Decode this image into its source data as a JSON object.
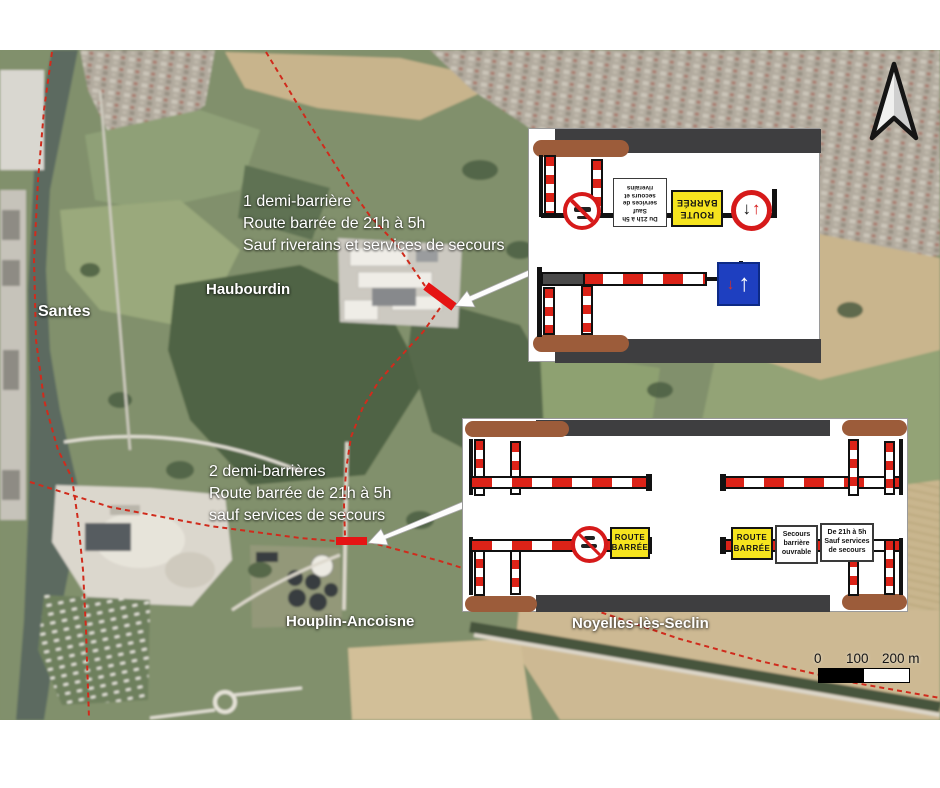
{
  "map": {
    "city_labels": [
      {
        "label": "Santes"
      },
      {
        "label": "Haubourdin"
      },
      {
        "label": "Houplin-Ancoisne"
      },
      {
        "label": "Noyelles-lès-Seclin"
      }
    ],
    "annotation_1": {
      "line1": "1 demi-barrière",
      "line2": "Route barrée de 21h à 5h",
      "line3": "Sauf riverains et services de secours"
    },
    "annotation_2": {
      "line1": "2 demi-barrières",
      "line2": "Route barrée de 21h à 5h",
      "line3": "sauf services de secours"
    }
  },
  "inset_top": {
    "time_sign": {
      "line1": "Du 21h à 5h",
      "line2": "Sauf",
      "line3": "services de",
      "line4": "secours et",
      "line5": "riverains"
    },
    "route_barree_sign": {
      "line1": "ROUTE",
      "line2": "BARRÉE"
    }
  },
  "inset_bottom": {
    "route_barree_left": {
      "line1": "ROUTE",
      "line2": "BARRÉE"
    },
    "route_barree_right": {
      "line1": "ROUTE",
      "line2": "BARRÉE"
    },
    "secours_sign": {
      "line1": "Secours",
      "line2": "barrière",
      "line3": "ouvrable"
    },
    "time_sign": {
      "line1": "De 21h à 5h",
      "line2": "Sauf services",
      "line3": "de secours"
    }
  },
  "scale_bar": {
    "tick0": "0",
    "tick100": "100",
    "tick200": "200 m"
  },
  "icons": {
    "up_arrow": "↑",
    "down_arrow": "↓"
  },
  "colors": {
    "boundary_red": "#d02b1c",
    "barrier_mark_red": "#e51414",
    "sign_yellow": "#f6e41e",
    "sign_blue": "#1e3fc0",
    "road_gray": "#3e3e40",
    "verge_brown": "#9c5c3a"
  }
}
